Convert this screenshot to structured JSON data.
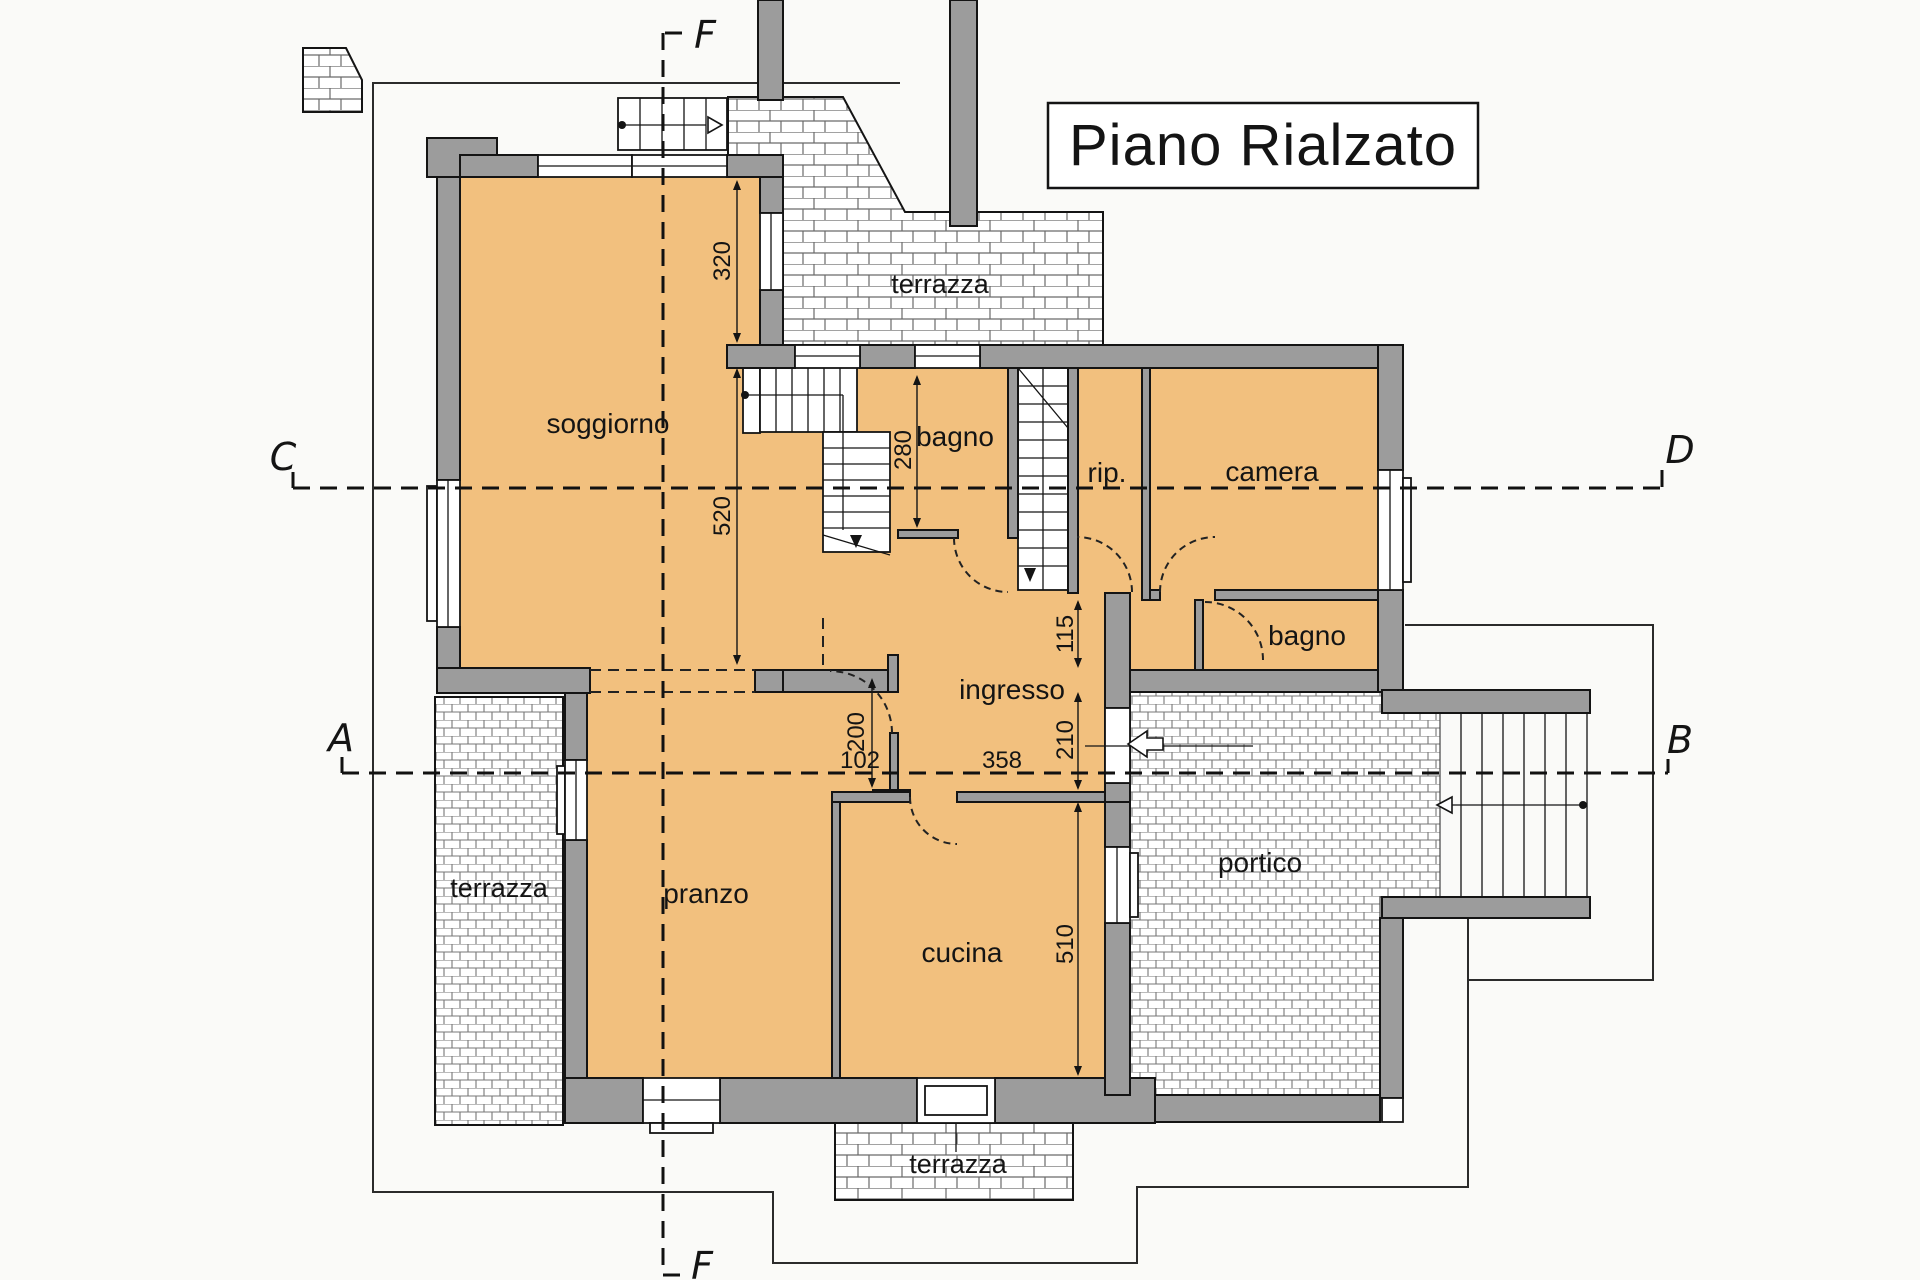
{
  "title": "Piano Rialzato",
  "rooms": {
    "soggiorno": "soggiorno",
    "pranzo": "pranzo",
    "cucina": "cucina",
    "ingresso": "ingresso",
    "bagno1": "bagno",
    "bagno2": "bagno",
    "rip": "rip.",
    "camera": "camera",
    "portico": "portico",
    "terrazza_top": "terrazza",
    "terrazza_left": "terrazza",
    "terrazza_bottom": "terrazza"
  },
  "dimensions": {
    "d320": "320",
    "d520": "520",
    "d280": "280",
    "d115": "115",
    "d210": "210",
    "d200": "200",
    "d102": "102",
    "d358": "358",
    "d510": "510"
  },
  "sections": {
    "a": "A",
    "b": "B",
    "c": "C",
    "d": "D",
    "f_top": "F",
    "f_bottom": "F"
  },
  "colors": {
    "room_fill": "#f2c07e",
    "wall_fill": "#9c9c9c",
    "paper": "#fafaf8",
    "ink": "#141414",
    "hatch_line": "#666666"
  }
}
